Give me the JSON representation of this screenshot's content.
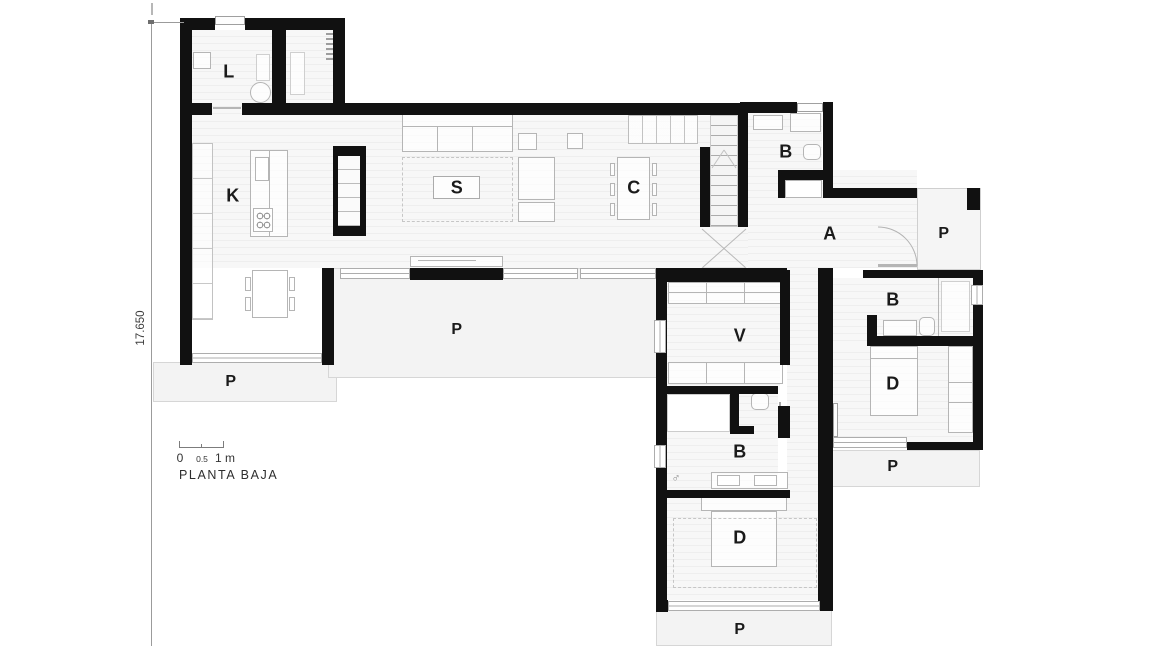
{
  "title": "PLANTA BAJA",
  "dimension": {
    "value": "17.650"
  },
  "scalebar": {
    "zero": "0",
    "half": "0.5",
    "one": "1 m"
  },
  "rooms": {
    "laundry": "L",
    "kitchen": "K",
    "living": "S",
    "dining": "C",
    "bath_top": "B",
    "hall": "A",
    "porch_entry": "P",
    "porch_central": "P",
    "porch_kitchen": "P",
    "dressing": "V",
    "bath_wing": "B",
    "bed_wing": "D",
    "porch_wing": "P",
    "bath_right": "B",
    "bed_right": "D",
    "porch_right": "P",
    "male_symbol": "♂"
  },
  "colors": {
    "wall": "#111111",
    "floor_stripe": "#eeeeee",
    "porch": "#f3f3f3",
    "annotation": "#3c3c3c"
  }
}
